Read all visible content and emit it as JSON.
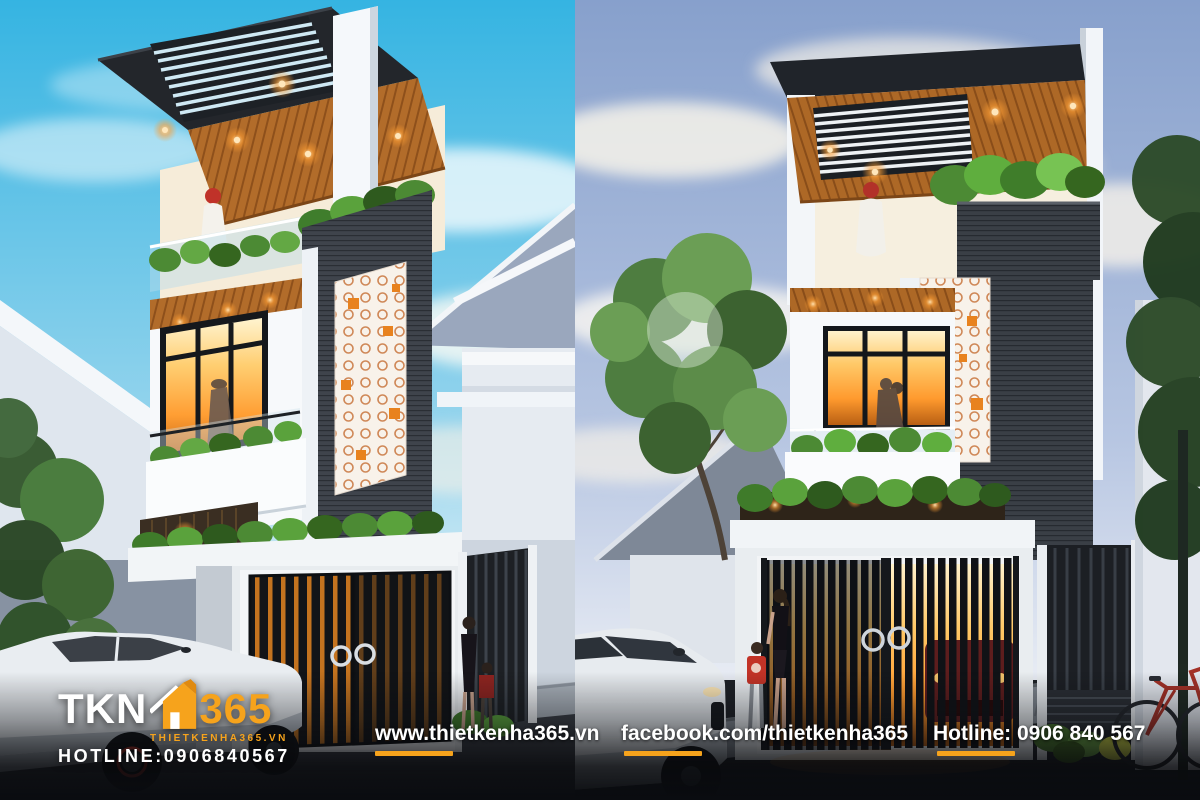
{
  "watermark": {
    "tkn": "TKN",
    "n365": "365",
    "site": "THIETKENHA365.VN",
    "hotline": "HOTLINE:0906840567"
  },
  "footer": {
    "website": "www.thietkenha365.vn",
    "facebook": "facebook.com/thietkenha365",
    "hotline": "Hotline: 0906 840 567"
  },
  "scenes": {
    "left": "3-storey modern townhouse render — daytime",
    "right": "3-storey modern townhouse render — dusk"
  },
  "colors": {
    "accent": "#F6A31C",
    "footer-bg": "#0A0C10",
    "sky-day": "#3AB7E3",
    "sky-dusk": "#8CA4D0",
    "wood": "#B26C2A",
    "warm-light": "#FF9E33",
    "charcoal": "#3F444C"
  }
}
